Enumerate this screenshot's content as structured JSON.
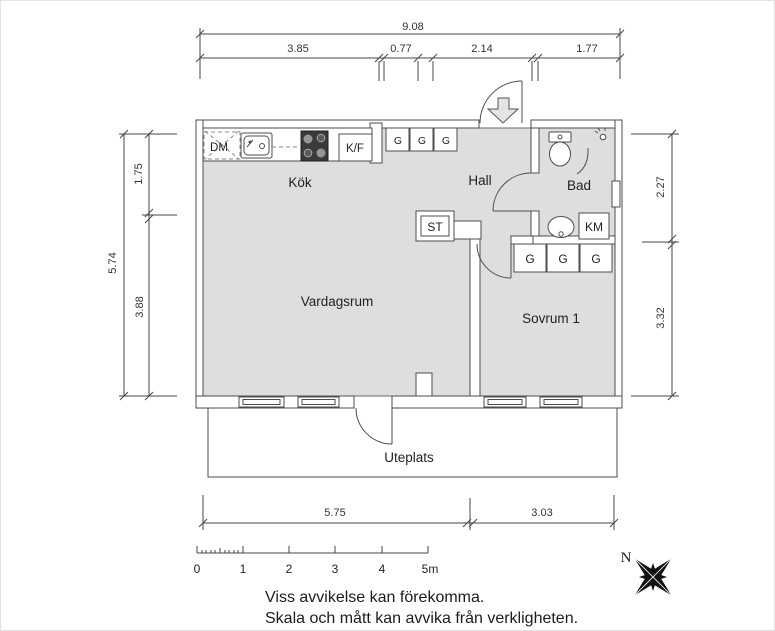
{
  "rooms": {
    "kitchen": "Kök",
    "hall": "Hall",
    "bathroom": "Bad",
    "living_room": "Vardagsrum",
    "bedroom": "Sovrum 1",
    "patio": "Uteplats"
  },
  "appliances": {
    "dishwasher": "DM",
    "fridge_freezer": "K/F",
    "closet": "ST",
    "washing_machine": "KM"
  },
  "wardrobes": {
    "hall": [
      "G",
      "G",
      "G"
    ],
    "bedroom": [
      "G",
      "G",
      "G"
    ]
  },
  "dimensions": {
    "top_total": "9.08",
    "top_segments": [
      "3.85",
      "0.77",
      "2.14",
      "1.77"
    ],
    "left_total": "5.74",
    "left_segments": [
      "1.75",
      "3.88"
    ],
    "right_segments": [
      "2.27",
      "3.32"
    ],
    "bottom_segments": [
      "5.75",
      "3.03"
    ]
  },
  "scale_bar": {
    "labels": [
      "0",
      "1",
      "2",
      "3",
      "4",
      "5m"
    ]
  },
  "compass": {
    "north": "N"
  },
  "disclaimer": {
    "line1": "Viss avvikelse kan förekomma.",
    "line2": "Skala och mått kan avvika från verkligheten."
  },
  "colors": {
    "floor": "#dedede",
    "wall": "#ffffff",
    "outline": "#4d4d4d",
    "stove": "#3a3a3a",
    "dim_lines": "#474747"
  }
}
